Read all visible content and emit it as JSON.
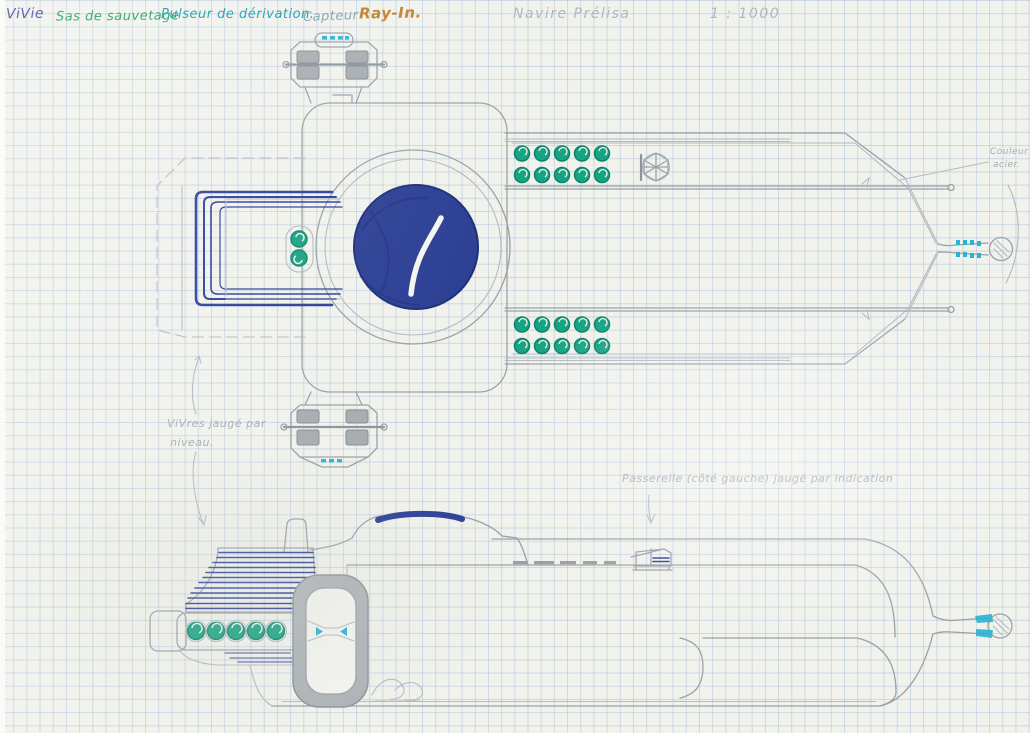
{
  "page": {
    "title": "Navire Prélisa",
    "scale": "1 : 1000"
  },
  "legend": {
    "items": [
      {
        "label": "ViVie",
        "color": "#4446a9"
      },
      {
        "label": "Sas de sauvetage",
        "color": "#1f9e63"
      },
      {
        "label": "Pulseur de dérivation.",
        "color": "#1898b4"
      },
      {
        "label": "Capteur",
        "color": "#7da4b0"
      },
      {
        "label": "Ray-In.",
        "color": "#bf7f2a"
      }
    ]
  },
  "annotations": {
    "supplies_line1": "ViVres jaugé par",
    "supplies_line2": "niveau.",
    "bridge": "Passerelle (côté gauche) jaugé par indication",
    "steel_line1": "Couleur",
    "steel_line2": "acier."
  },
  "colors": {
    "paper": "#f1f2ec",
    "grid_line": "#bccde0",
    "pencil": "#9aa1a7",
    "ink_blue": "#2a3f98",
    "ink_green": "#18a383",
    "ink_cyan": "#2ab3d1",
    "ink_orange": "#bf7f2a"
  }
}
